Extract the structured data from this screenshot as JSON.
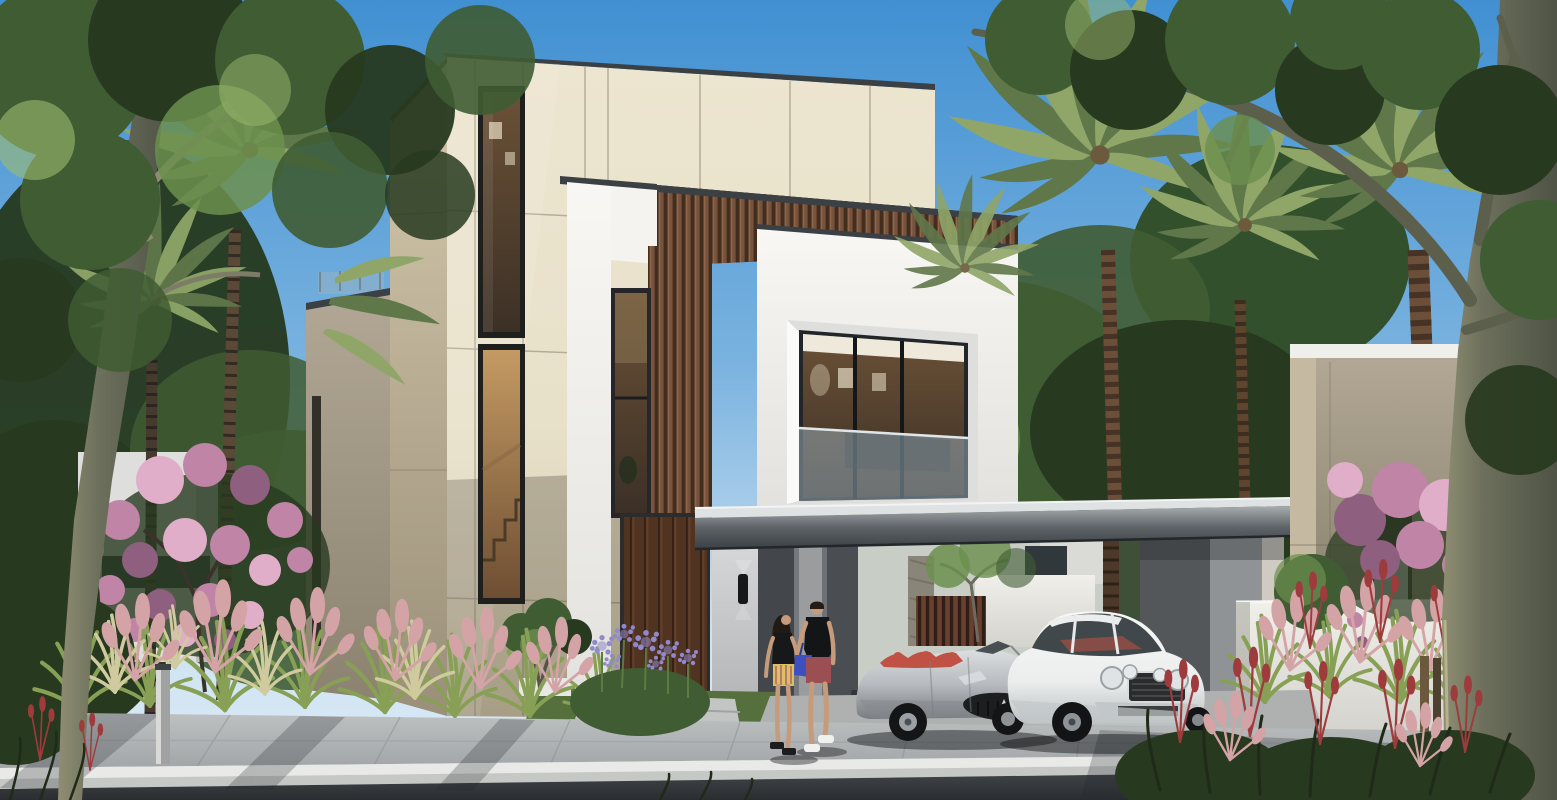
{
  "scene": {
    "description": "Daytime architectural rendering of a modern two-storey villa: cream stone tower with tall stair window, white cubic volume with large recessed glass window, vertical walnut wood-slat cladding, tall wooden entry door with black wall sconce, flat dark carport canopy sheltering a silver convertible with red seats and a white luxury coupe, a couple walking toward the entrance, palm trees, a pink blossoming tree, ornamental pink and green grasses, purple agapanthus, a white boundary wall with bougainvillea, neighbouring villas, a paved sidewalk, white curb and asphalt road in the foreground",
    "objects": {
      "villa": "main villa",
      "tower": "stone tower with stair window",
      "window_box": "white volume with recessed window and glass balustrade",
      "wood_cladding": "vertical wood slat cladding",
      "entry_door": "tall wooden pivot door",
      "sconce": "black up-down wall light",
      "carport": "flat-roof carport canopy",
      "car_left": "silver convertible with red interior",
      "car_right": "white luxury coupe",
      "person_left": "woman in black top and patterned shorts",
      "person_right": "man in black t-shirt with blue bag",
      "vegetation": "palms, blossom tree, bougainvillea, ornamental grasses",
      "street": "sidewalk, white curb, asphalt road",
      "bollard": "metal bollard light",
      "counts": {
        "cars": 2,
        "people": 2
      }
    }
  },
  "colors": {
    "sky_top": "#4190d2",
    "sky_mid": "#79b2df",
    "sky_horizon": "#cfe3f2",
    "foliage_dark": "#27391f",
    "foliage": "#3f5c33",
    "foliage_light": "#6c8f4e",
    "foliage_sun": "#9dba6f",
    "palm": "#8fa668",
    "palm_dark": "#60774a",
    "trunk": "#6f523d",
    "trunk_dark": "#38302a",
    "bark": "#8f8e73",
    "bark_dark": "#4f5345",
    "stone": "#e8e1ca",
    "stone_shade": "#d3c8ab",
    "stone_dark": "#b4a88e",
    "greige": "#a79c88",
    "greige_dark": "#8b8270",
    "white": "#f4f3f0",
    "white_shade": "#dededc",
    "white_dark": "#bfc0bf",
    "wall_white": "#e7e5e0",
    "wood": "#7b5641",
    "wood_dark": "#432d1d",
    "door": "#5d3b27",
    "door_dark": "#3c2517",
    "roof_top": "#dfe2e3",
    "roof_dark": "#3b4044",
    "glass_dark": "#31383c",
    "glass_blue": "#9db3bf",
    "interior": "#c8a36f",
    "interior_dark": "#4c3a2a",
    "gray_col": "#43474b",
    "gray_col_light": "#7e8286",
    "gray_wall": "#8f9396",
    "gray_wall_dark": "#5f6366",
    "sidewalk": "#b3b6b7",
    "sidewalk_dark": "#989c9e",
    "curb": "#e9eae8",
    "curb_face": "#c6c8c6",
    "road": "#34383b",
    "lawn": "#55703d",
    "blossom": "#c084a6",
    "blossom_light": "#e0aec8",
    "blossom_dark": "#8e5f7e",
    "grass_green": "#87a055",
    "grass_pale": "#cfcb9e",
    "grass_pink": "#d4a3a6",
    "grass_red": "#9e3b3c",
    "lavender": "#9089cc",
    "silver": "#b7babe",
    "silver_dark": "#85898d",
    "silver_hi": "#dcdfe1",
    "car_white": "#eceeee",
    "car_white_dark": "#c2c7c9",
    "seat_red": "#bf5244",
    "skin": "#c59b7b",
    "cloth_black": "#1e1f21",
    "shorts_red": "#9c4f52",
    "shorts_gold": "#d8c064",
    "bag_blue": "#3e50c0",
    "metal": "#caccca"
  }
}
